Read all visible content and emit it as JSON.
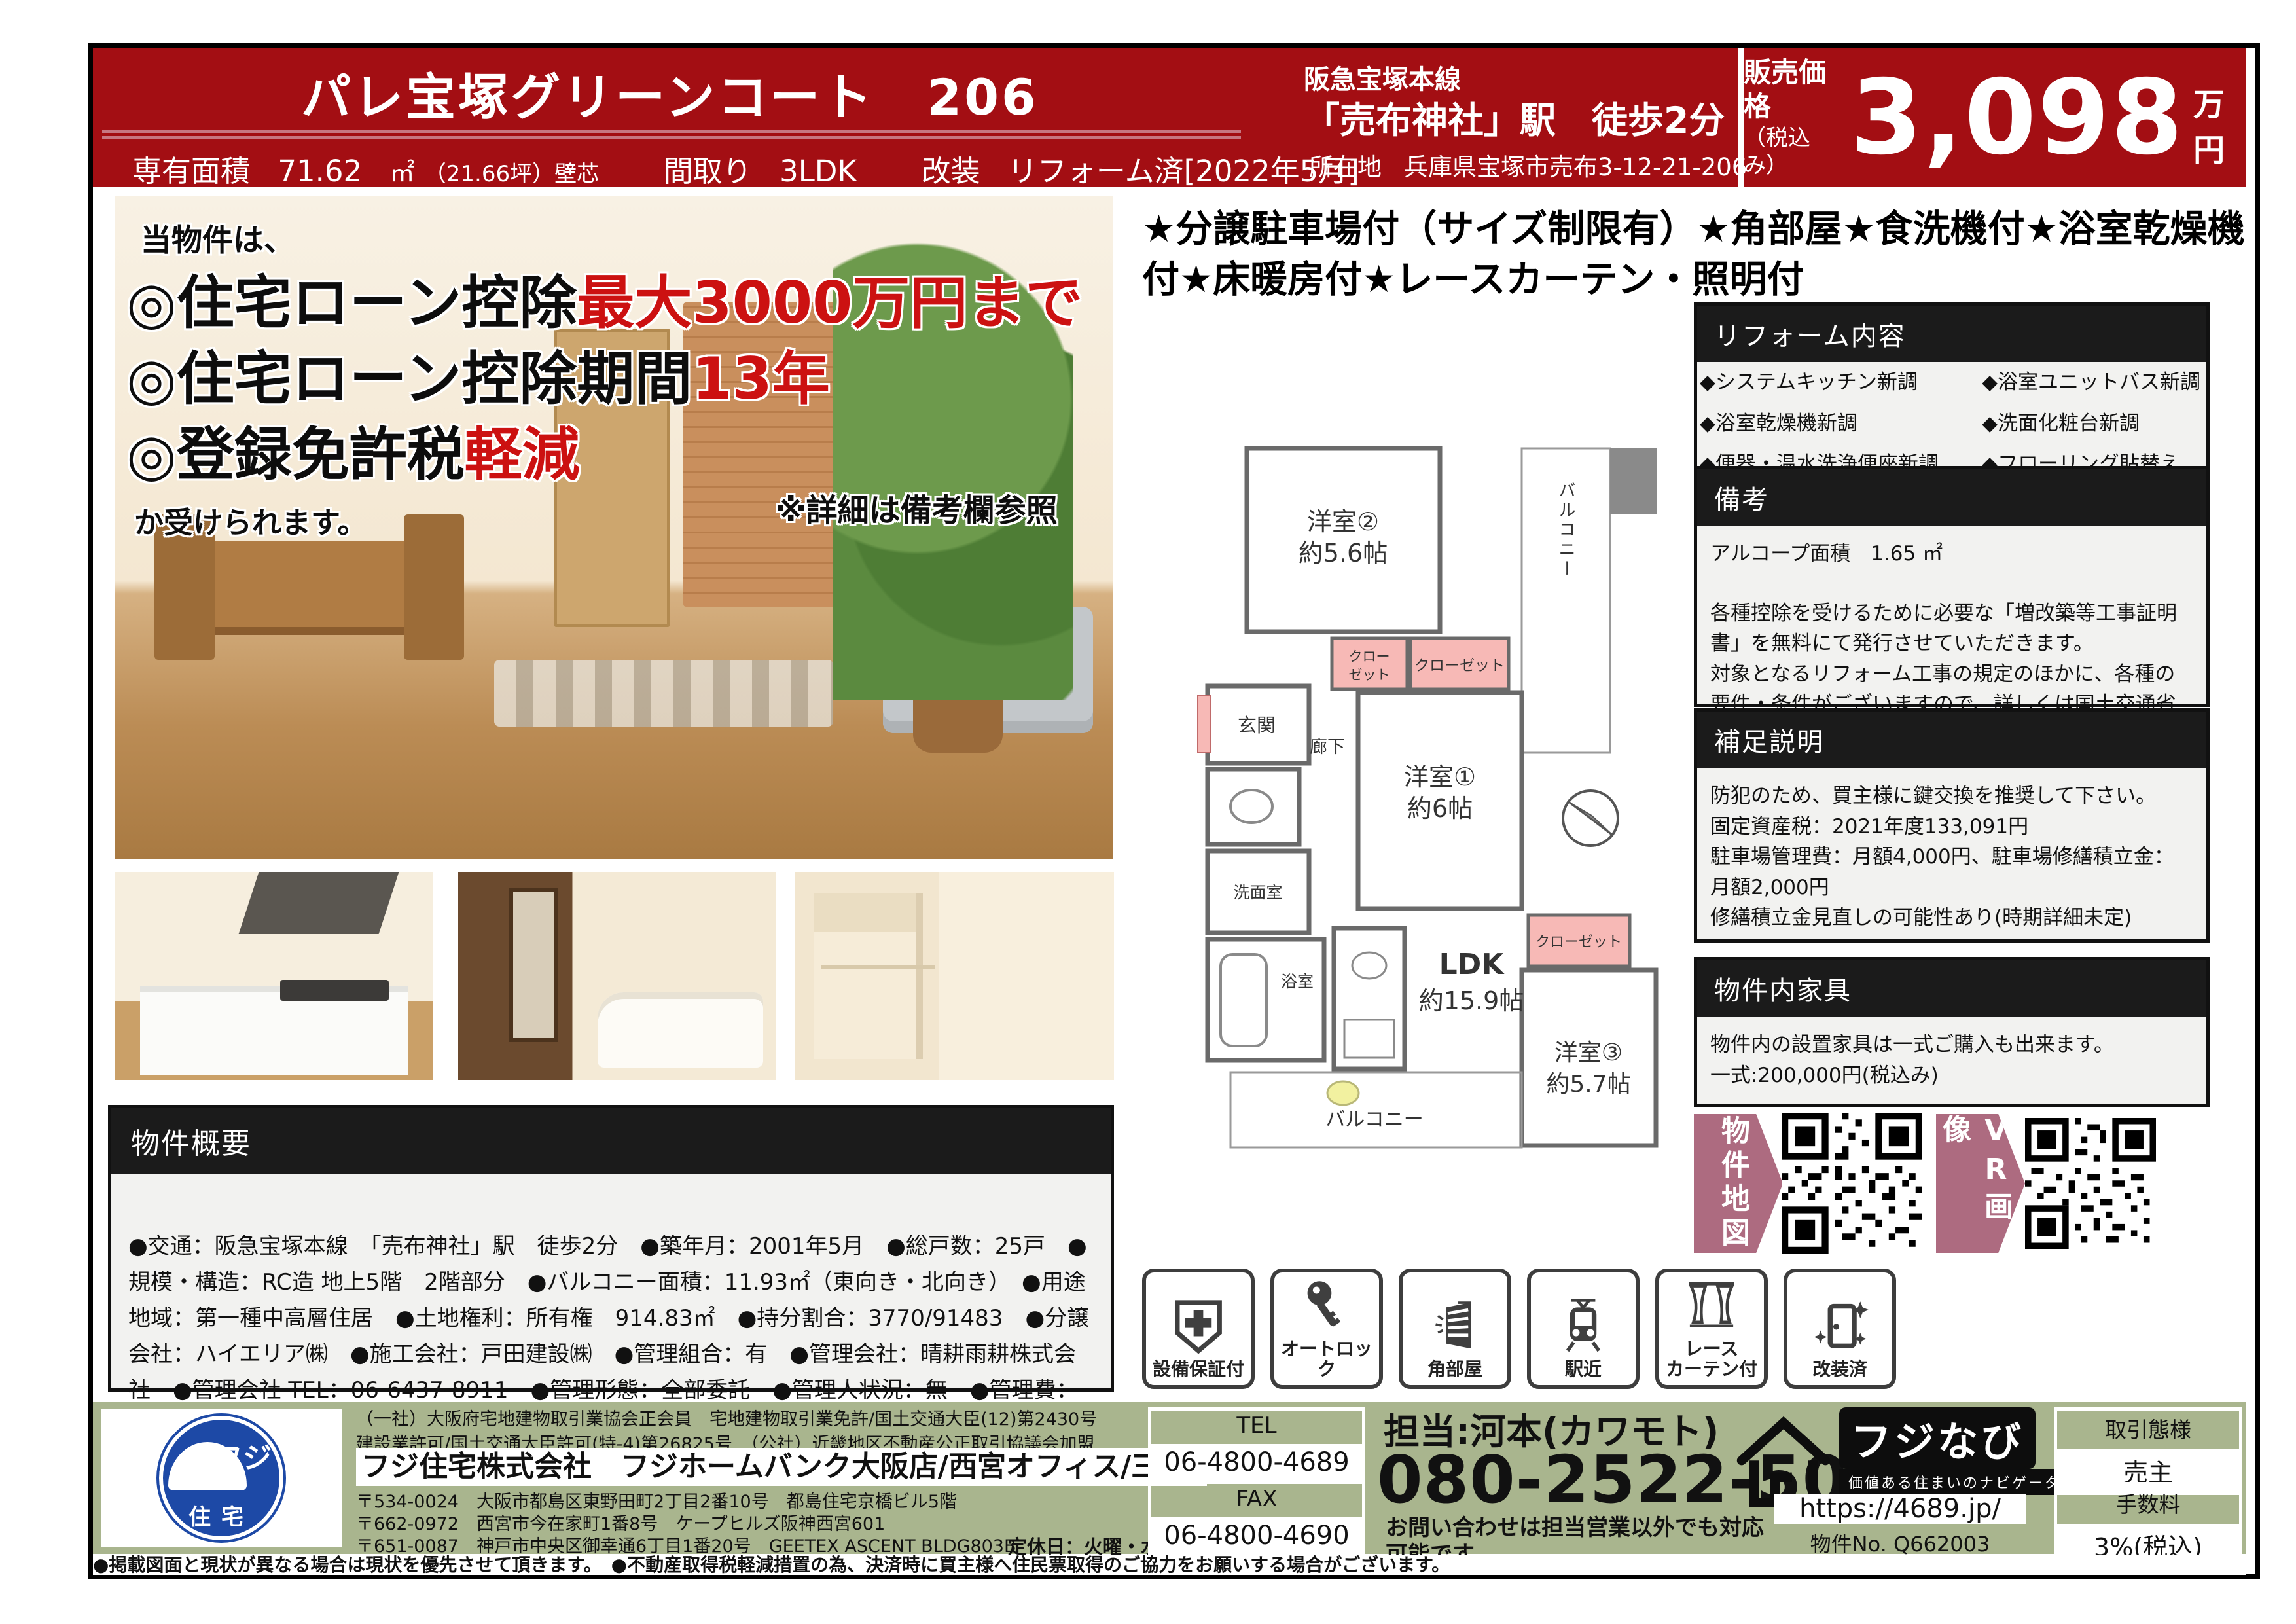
{
  "colors": {
    "brand_red": "#a30e13",
    "footer_green": "#a9b58e",
    "accent_mauve": "#ad6b80",
    "closet_pink": "#f7b9b6",
    "highlight_red": "#cc1111"
  },
  "header": {
    "title": "パレ宝塚グリーンコート　206",
    "specs": {
      "area_label": "専有面積",
      "area_value": "71.62",
      "area_unit": "㎡",
      "area_note": "（21.66坪）壁芯",
      "madori_label": "間取り",
      "madori_value": "3LDK",
      "kaisou_label": "改装",
      "kaisou_value": "リフォーム済[2022年5月]"
    },
    "station_line1": "阪急宝塚本線",
    "station_line2": "「売布神社」駅　徒歩2分",
    "address_label": "所在地",
    "address_value": "兵庫県宝塚市売布3-12-21-206",
    "price_label": "販売価格",
    "price_tax_note": "（税込み）",
    "price_value": "3,098",
    "price_unit": "万円"
  },
  "photo_overlay": {
    "intro": "当物件は、",
    "line1_black": "◎住宅ローン控除",
    "line1_red": "最大3000万円まで",
    "line2_black": "◎住宅ローン控除期間",
    "line2_red": "13年",
    "line3_black": "◎登録免許税",
    "line3_red": "軽減",
    "outro": "か受けられます。",
    "note": "※詳細は備考欄参照"
  },
  "catchphrase": "★分譲駐車場付（サイズ制限有）★角部屋★食洗機付★浴室乾燥機付★床暖房付★レースカーテン・照明付",
  "floorplan": {
    "room2_name": "洋室②",
    "room2_size": "約5.6帖",
    "room1_name": "洋室①",
    "room1_size": "約6帖",
    "ldk_name": "LDK",
    "ldk_size": "約15.9帖",
    "room3_name": "洋室③",
    "room3_size": "約5.7帖",
    "closet_small_l1": "クロー",
    "closet_small_l2": "ゼット",
    "closet2": "クローゼット",
    "closet3": "クローゼット",
    "genkan": "玄関",
    "rouka": "廊下",
    "senmen": "洗面室",
    "yokushitsu": "浴室",
    "balcony_top": "バルコニー",
    "balcony_bottom": "バルコニー"
  },
  "sections": {
    "reform": {
      "title": "リフォーム内容",
      "items": [
        "◆システムキッチン新調",
        "◆浴室ユニットバス新調",
        "◆浴室乾燥機新調",
        "◆洗面化粧台新調",
        "◆便器・温水洗浄便座新調",
        "◆フローリング貼替え"
      ]
    },
    "bikou": {
      "title": "備考",
      "line1": "アルコープ面積　1.65 ㎡",
      "para1": "各種控除を受けるために必要な「増改築等工事証明書」を無料にて発行させていただきます。",
      "para2": "対象となるリフォーム工事の規定のほかに、各種の要件・条件がございますので、詳しくは国土交通省ホームページの「買取再販で扱われる住宅の取得に係る特例措置」をご覧ください。"
    },
    "hosoku": {
      "title": "補足説明",
      "line1": "防犯のため、買主様に鍵交換を推奨して下さい。",
      "line2": "固定資産税：2021年度133,091円",
      "line3": "駐車場管理費：月額4,000円、駐車場修繕積立金：月額2,000円",
      "line4": "修繕積立金見直しの可能性あり(時期詳細未定)"
    },
    "kagu": {
      "title": "物件内家具",
      "line1": "物件内の設置家具は一式ご購入も出来ます。",
      "line2": "一式:200,000円(税込み)"
    }
  },
  "overview": {
    "title": "物件概要",
    "text": "●交通：阪急宝塚本線　「売布神社」駅　徒歩2分　●築年月：2001年5月　●総戸数：25戸　●規模・構造：RC造 地上5階　2階部分　●バルコニー面積：11.93㎡（東向き・北向き）　●用途地域：第一種中高層住居　●土地権利：所有権　914.83㎡　●持分割合：3770/91483　●分譲会社：ハイエリア㈱　●施工会社：戸田建設㈱　●管理組合：有　●管理会社：晴耕雨耕株式会社　●管理会社 TEL：06-6437-8911　●管理形態：全部委託　●管理人状況：無　●管理費：月額 13,970 円　●修繕積立費：月額 15,040 円　●ガス：都市ガス　●給湯：ガス給湯器　●現況：空家　●ペット：不可"
  },
  "qr": {
    "map_label": "物件地図",
    "vr_label": "VR画像"
  },
  "feature_icons": [
    {
      "label": "設備保証付",
      "icon": "shield-plus-icon"
    },
    {
      "label": "オートロック",
      "icon": "key-icon"
    },
    {
      "label": "角部屋",
      "icon": "corner-building-icon"
    },
    {
      "label": "駅近",
      "icon": "train-icon"
    },
    {
      "label": "レース\nカーテン付",
      "icon": "curtains-icon"
    },
    {
      "label": "改装済",
      "icon": "door-sparkle-icon"
    }
  ],
  "footer": {
    "license_line1": "（一社）大阪府宅地建物取引業協会正会員　宅地建物取引業免許/国土交通大臣(12)第2430号",
    "license_line2": "建設業許可/国土交通大臣許可(特-4)第26825号　（公社）近畿地区不動産公正取引協議会加盟",
    "company": "フジ住宅株式会社　フジホームバンク大阪店/西宮オフィス/三宮オフィス",
    "address1": "〒534-0024　大阪市都島区東野田町2丁目2番10号　都島住宅京橋ビル5階",
    "address2": "〒662-0972　西宮市今在家町1番8号　ケープヒルズ阪神西宮601",
    "address3": "〒651-0087　神戸市中央区御幸通6丁目1番20号　GEETEX ASCENT BLDG803B",
    "holiday": "定休日：火曜・水曜・他",
    "tel_label": "TEL",
    "tel": "06-4800-4689",
    "fax_label": "FAX",
    "fax": "06-4800-4690",
    "contact_person": "担当:河本(カワモト)",
    "mobile": "080-2522-5022",
    "contact_note": "お問い合わせは担当営業以外でも対応可能です。",
    "fujinavi": "フジなび",
    "fujinavi_tagline": "価値ある住まいのナビゲーター",
    "url": "https://4689.jp/",
    "property_no": "物件No. Q662003",
    "deal_type_label": "取引態様",
    "deal_type": "売主",
    "fee_label": "手数料",
    "fee": "3%(税込)",
    "logo_text_top": "フジ",
    "logo_text_bottom": "住宅"
  },
  "bottom_note": "●掲載図面と現状が異なる場合は現状を優先させて頂きます。　●不動産取得税軽減措置の為、決済時に買主様へ住民票取得のご協力をお願いする場合がございます。"
}
